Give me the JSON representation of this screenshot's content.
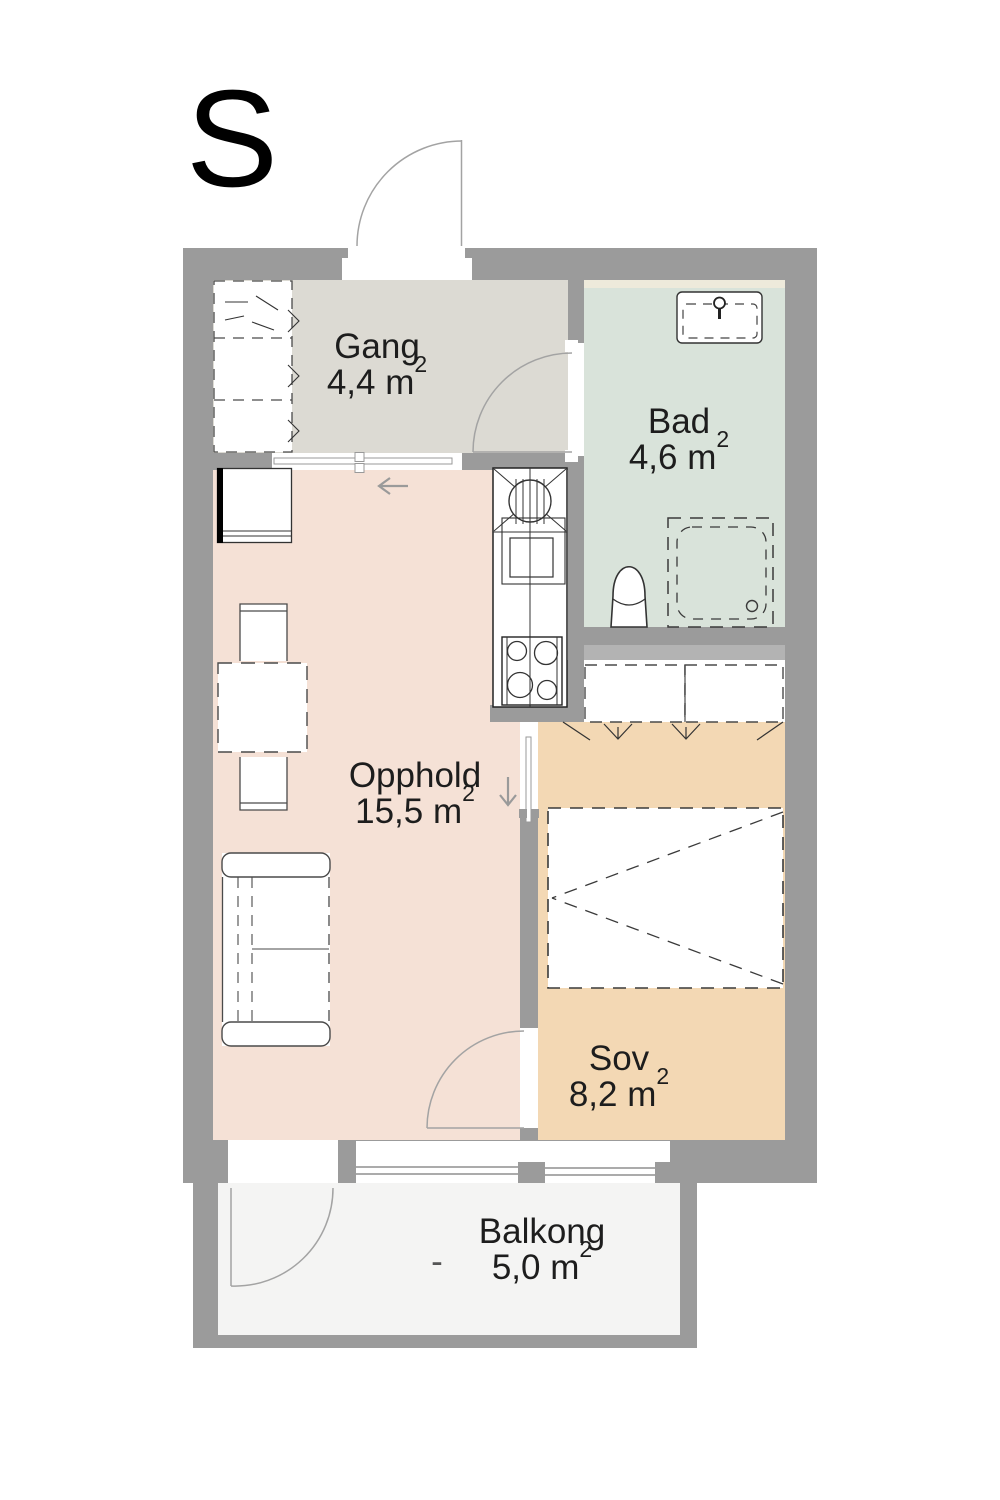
{
  "plan": {
    "orientation_label": "S",
    "rooms": {
      "gang": {
        "name": "Gang",
        "area": "4,4 m",
        "area_sup": "2"
      },
      "bad": {
        "name": "Bad",
        "area": "4,6 m",
        "area_sup": "2"
      },
      "opphold": {
        "name": "Opphold",
        "area": "15,5 m",
        "area_sup": "2"
      },
      "sov": {
        "name": "Sov",
        "area": "8,2 m",
        "area_sup": "2"
      },
      "balkong": {
        "name": "Balkong",
        "area": "5,0 m",
        "area_sup": "2",
        "dash": "-"
      }
    },
    "colors": {
      "wall": "#9b9b9b",
      "wall_light": "#b3b3b3",
      "gang_floor": "#dcdad3",
      "bad_floor": "#d9e3da",
      "bad_accent_strip": "#eeeadb",
      "opphold_floor": "#f5e1d6",
      "sov_floor": "#f3d8b4",
      "balkong_floor": "#f4f4f3",
      "door_line": "#a3a3a3",
      "furniture_line": "#3a3a3a",
      "text": "#1d1d1d"
    }
  }
}
